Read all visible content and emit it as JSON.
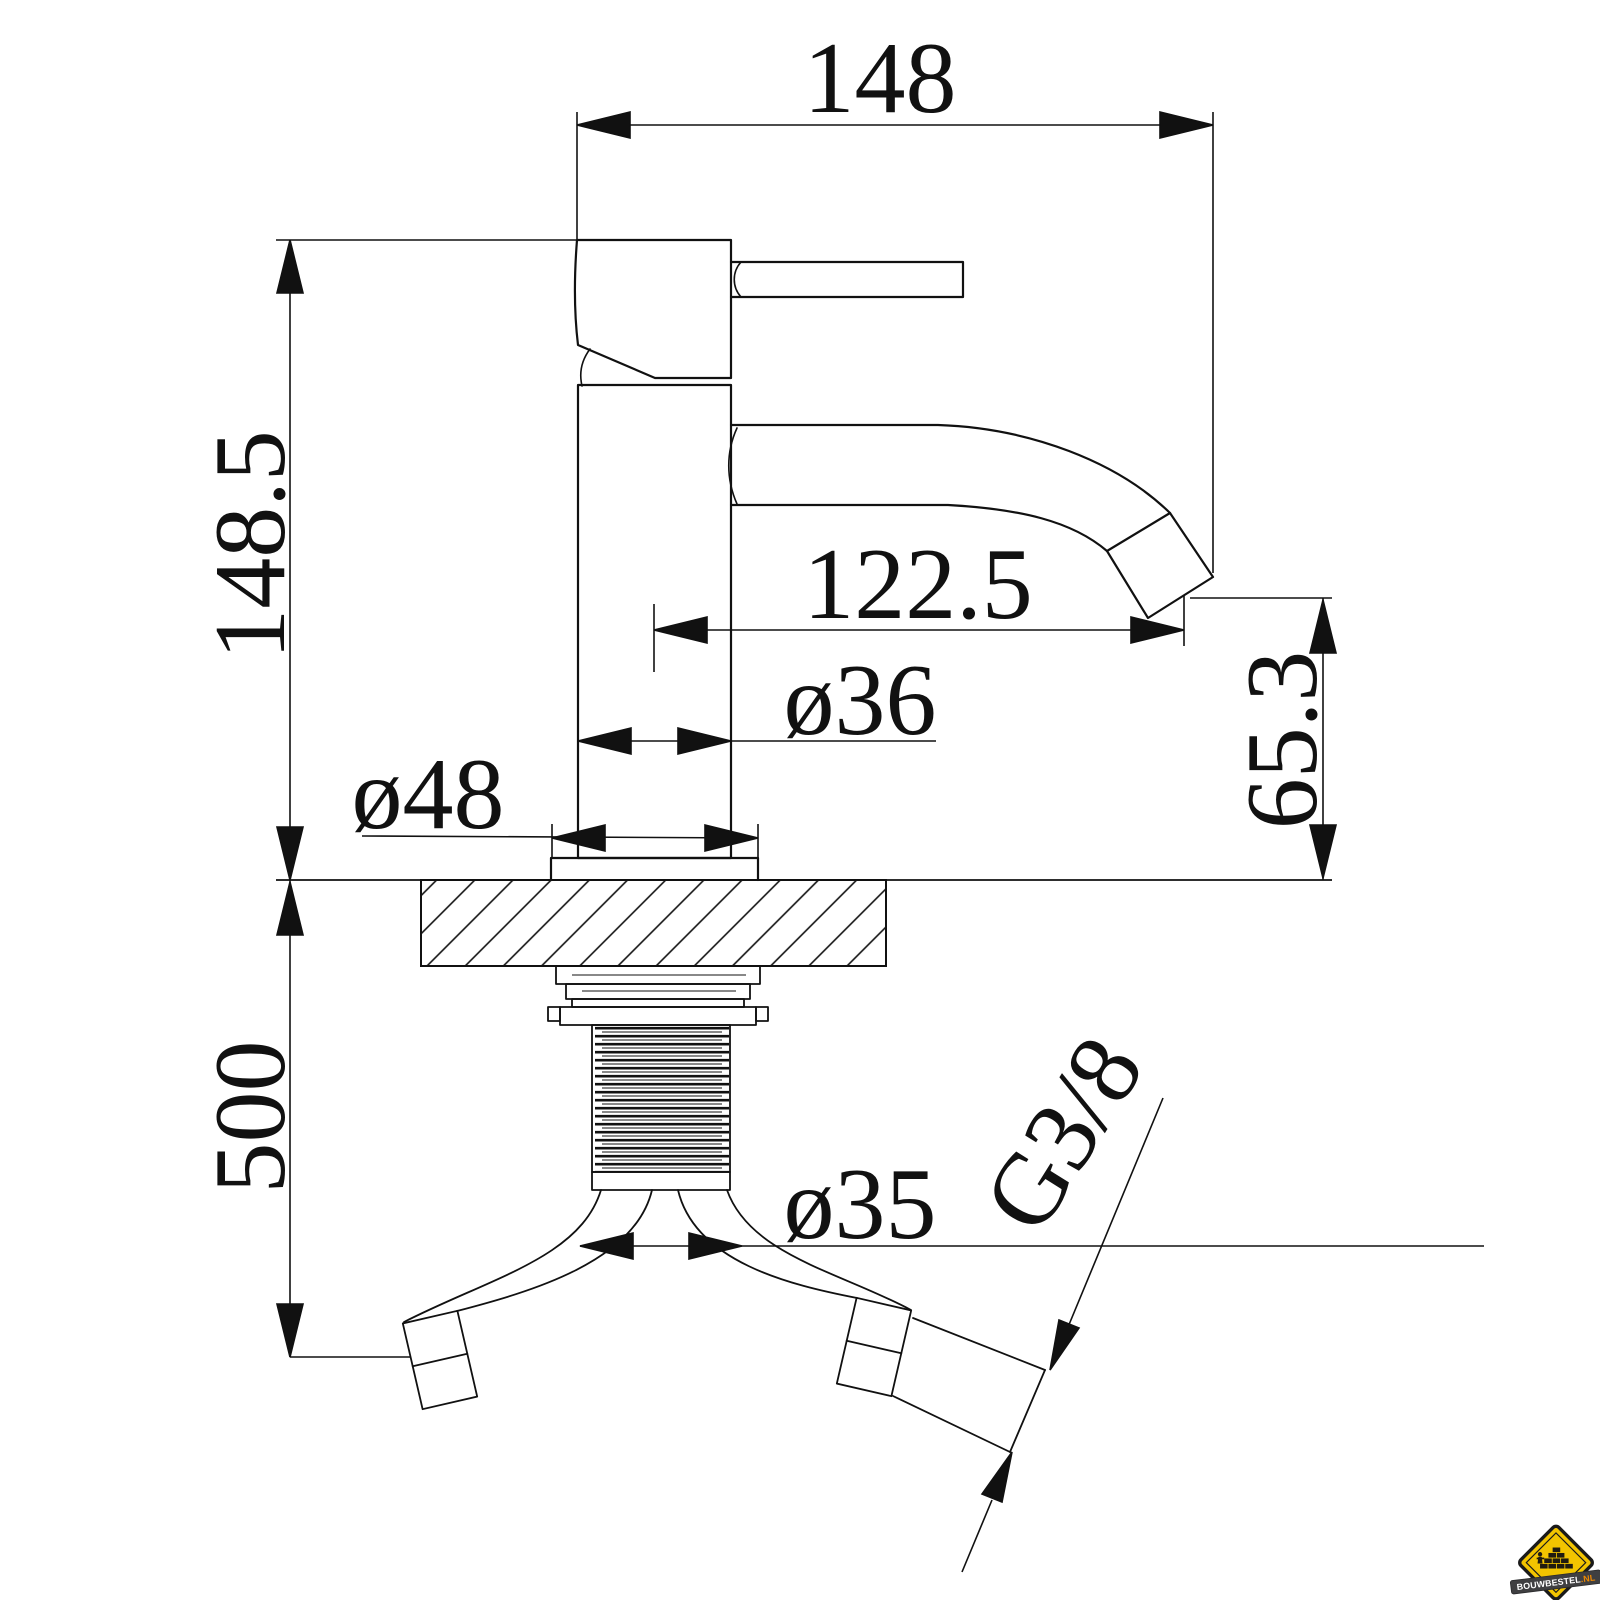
{
  "dims": {
    "overall_width": "148",
    "body_height": "148.5",
    "spout_reach": "122.5",
    "outlet_height": "65.3",
    "hose_length": "500",
    "body_diameter": "ø36",
    "base_diameter": "ø48",
    "hole_diameter": "ø35",
    "thread_size": "G3/8"
  },
  "logo": {
    "brand": "BOUWBESTEL",
    "suffix": ".NL"
  },
  "colors": {
    "line": "#111111",
    "background": "#ffffff",
    "logo_yellow": "#f2c400",
    "logo_border": "#1a1a1a",
    "logo_banner": "#3f3f41",
    "logo_suffix": "#f08a00"
  }
}
